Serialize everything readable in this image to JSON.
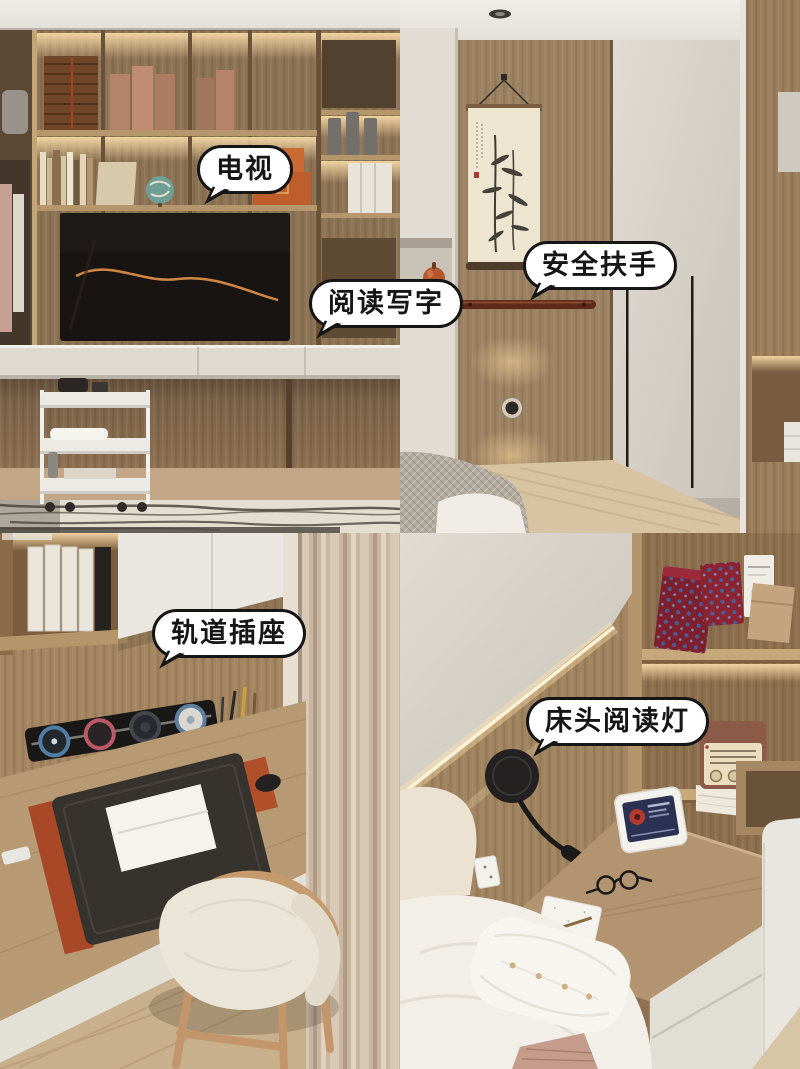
{
  "labels": {
    "tv": "电视",
    "reading_writing": "阅读写字",
    "safety_handrail": "安全扶手",
    "track_socket": "轨道插座",
    "bedside_reading_lamp": "床头阅读灯"
  },
  "style": {
    "bubble_fill": "#ffffff",
    "bubble_border": "#161616",
    "bubble_text_color": "#161616",
    "wood_accent": "#8d7355",
    "led_glow": "#f4d7a2"
  }
}
